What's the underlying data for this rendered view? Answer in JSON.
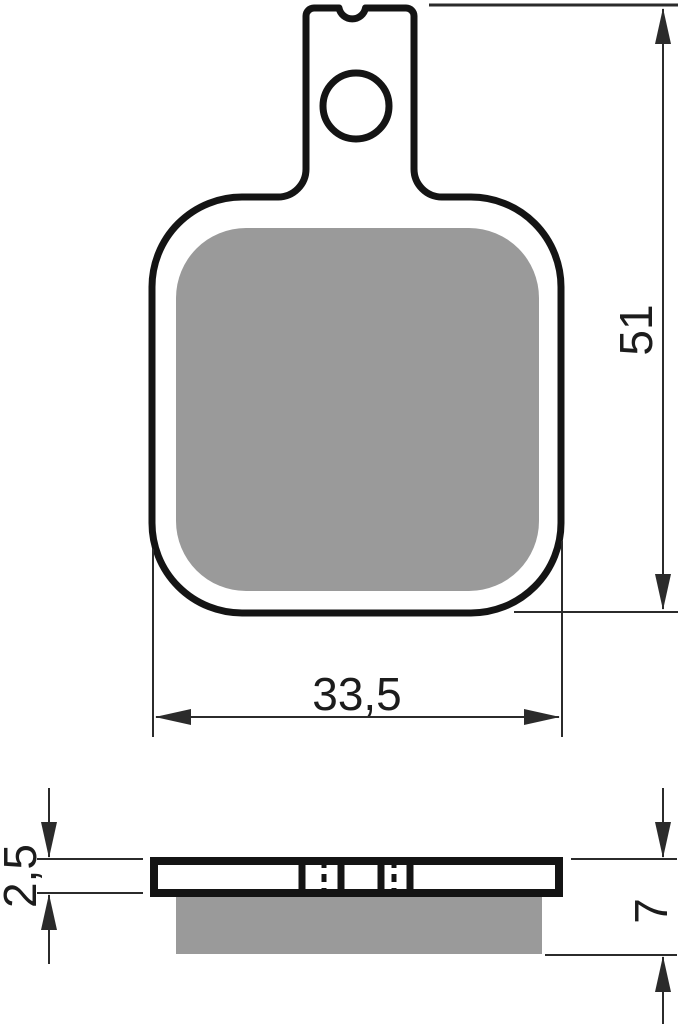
{
  "page": {
    "background": "#ffffff"
  },
  "front_view": {
    "height_dim": {
      "label": "51",
      "orientation": "vertical"
    },
    "width_dim": {
      "label": "33,5",
      "orientation": "horizontal"
    }
  },
  "side_view": {
    "backplate_dim": {
      "label": "2,5",
      "orientation": "vertical"
    },
    "total_dim": {
      "label": "7",
      "orientation": "vertical"
    }
  },
  "colors": {
    "outline": "#141414",
    "dimension_line": "#2b2b2b",
    "friction_material": "#9a9a9a",
    "background": "#ffffff"
  }
}
